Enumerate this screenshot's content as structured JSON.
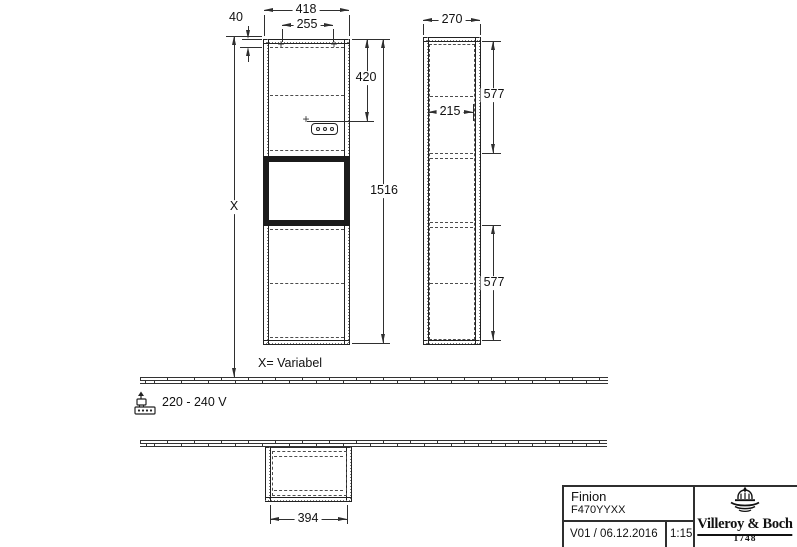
{
  "document_type": "technical-drawing",
  "colors": {
    "line": "#2f2f2f",
    "text": "#111111",
    "background": "#ffffff"
  },
  "dimensions": {
    "front_width": "418",
    "front_inner_width": "255",
    "front_top_gap": "40",
    "front_socket_height": "420",
    "front_total_height": "1516",
    "side_depth": "270",
    "side_inner_depth": "215",
    "side_upper_height": "577",
    "side_lower_height": "577",
    "plan_width": "394",
    "variable_symbol": "X"
  },
  "annotations": {
    "variable_note": "X= Variabel",
    "voltage": "220 - 240 V",
    "fixing_mark": "+",
    "socket_mark": "+"
  },
  "title_block": {
    "product_name": "Finion",
    "article_number": "F470YYXX",
    "version_date": "V01 / 06.12.2016",
    "scale": "1:15",
    "brand": "Villeroy & Boch",
    "brand_year": "1748"
  }
}
